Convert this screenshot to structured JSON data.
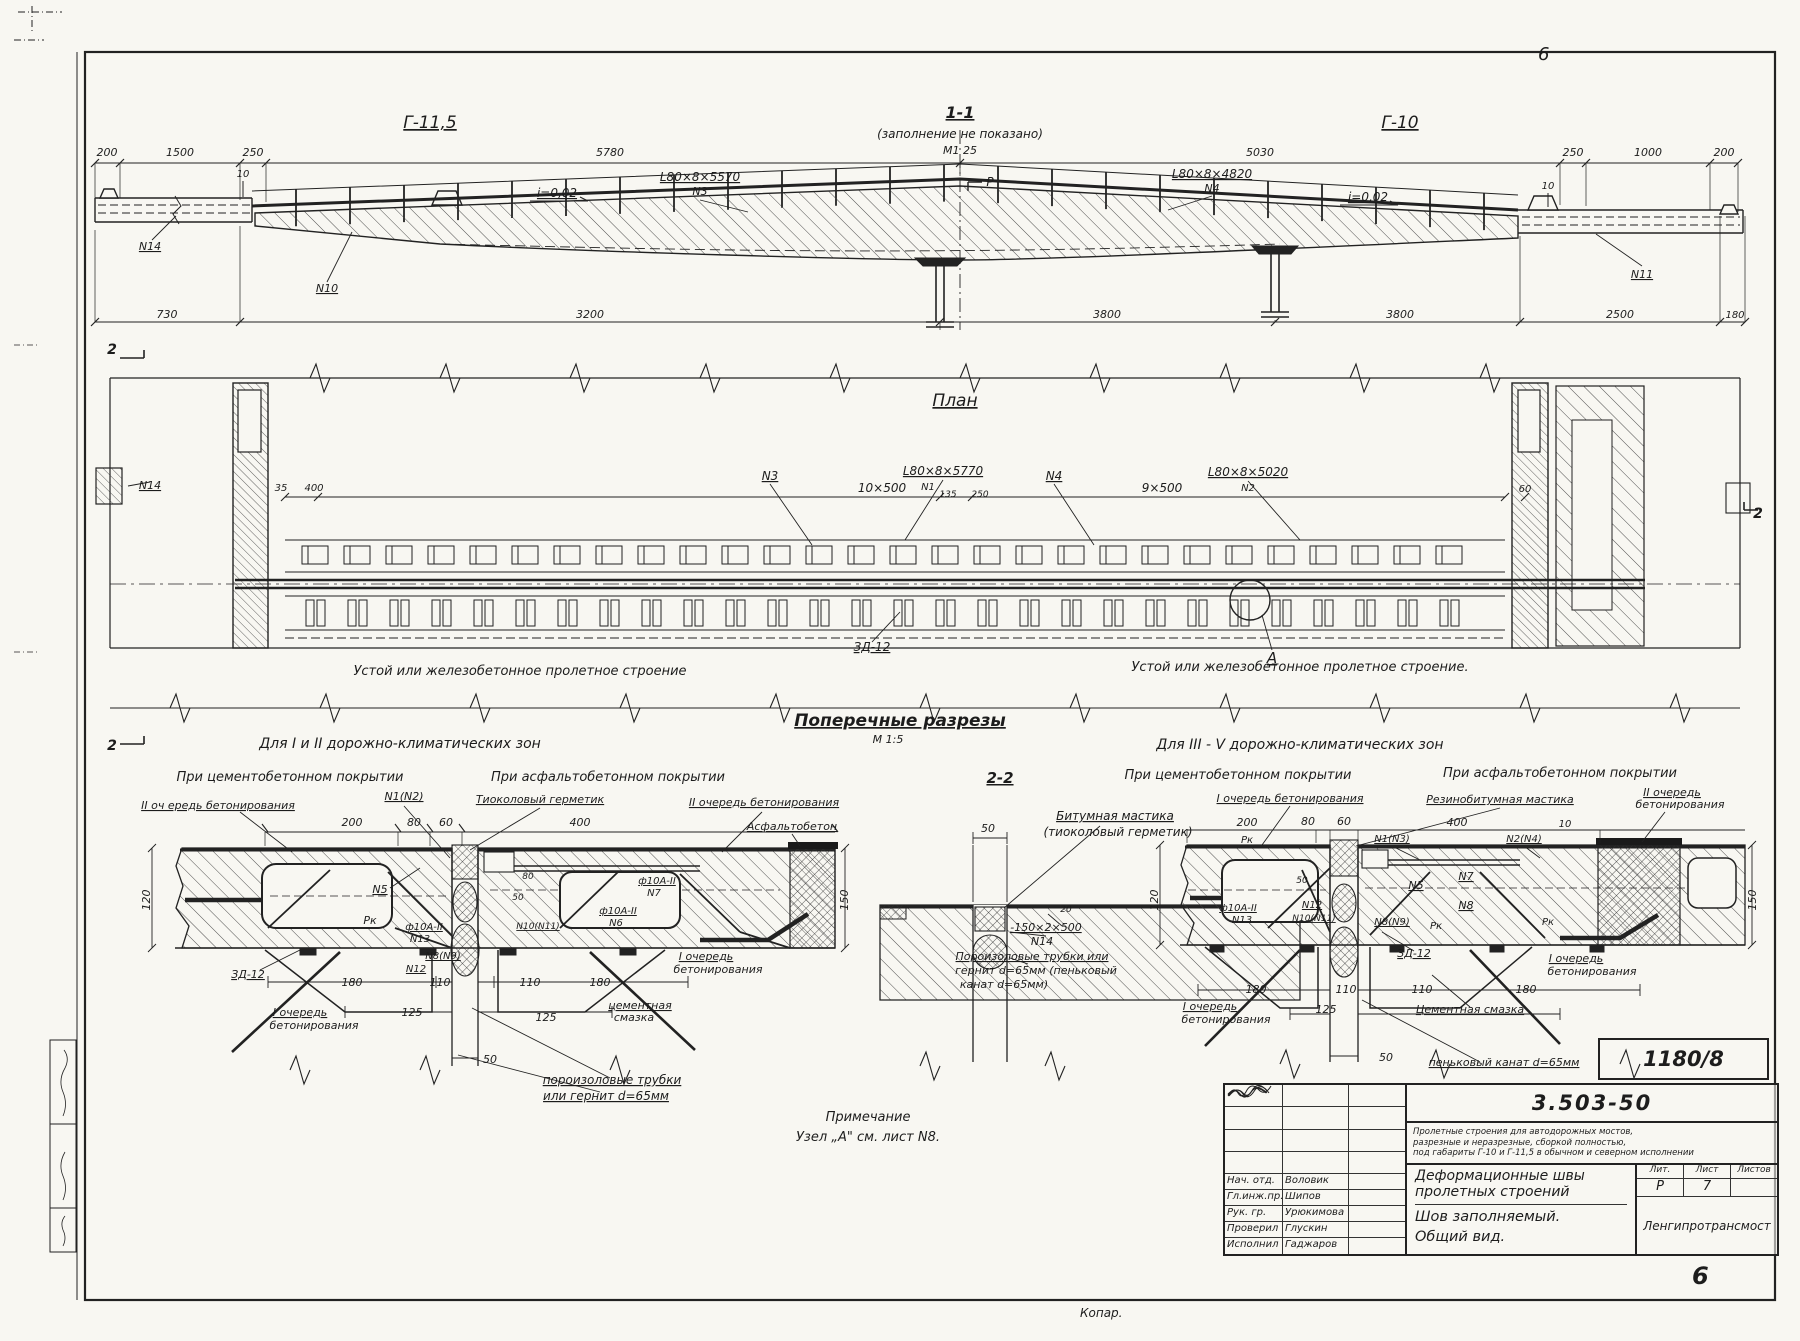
{
  "sheet": {
    "corner_mark": "6",
    "page_number": "6",
    "copier_note": "Копар.",
    "doc_stamp": "1180/8"
  },
  "title_block": {
    "series": "3.503-50",
    "desc_line1": "Пролетные строения для автодорожных мостов,",
    "desc_line2": "разрезные и неразрезные, сборкой полностью,",
    "desc_line3": "под габариты Г-10 и Г-11,5 в обычном и северном исполнении",
    "title_line1": "Деформационные швы",
    "title_line2": "пролетных строений",
    "sub_line1": "Шов заполняемый.",
    "sub_line2": "Общий вид.",
    "col_lit": "Лит.",
    "col_list": "Лист",
    "col_listov": "Листов",
    "val_lit": "Р",
    "val_list": "7",
    "val_listov": "",
    "org": "Ленгипротрансмост",
    "rows": [
      {
        "role": "Нач. отд.",
        "name": "Воловик"
      },
      {
        "role": "Гл.инж.пр.",
        "name": "Шипов"
      },
      {
        "role": "Рук. гр.",
        "name": "Урюкимова"
      },
      {
        "role": "Проверил",
        "name": "Глускин"
      },
      {
        "role": "Исполнил",
        "name": "Гаджаров"
      }
    ]
  },
  "drawing_labels": {
    "elevation": [
      {
        "t": "Г-11,5",
        "x": 430,
        "y": 128,
        "s": 17,
        "u": 1
      },
      {
        "t": "1-1",
        "x": 960,
        "y": 118,
        "s": 16,
        "u": 1,
        "w": 1
      },
      {
        "t": "(заполнение не показано)",
        "x": 960,
        "y": 138,
        "s": 12
      },
      {
        "t": "М1 25",
        "x": 960,
        "y": 154,
        "s": 11
      },
      {
        "t": "Г-10",
        "x": 1400,
        "y": 128,
        "s": 17,
        "u": 1
      },
      {
        "t": "200",
        "x": 107,
        "y": 156,
        "s": 11
      },
      {
        "t": "1500",
        "x": 180,
        "y": 156,
        "s": 11
      },
      {
        "t": "250",
        "x": 253,
        "y": 156,
        "s": 11
      },
      {
        "t": "5780",
        "x": 610,
        "y": 156,
        "s": 11
      },
      {
        "t": "5030",
        "x": 1260,
        "y": 156,
        "s": 11
      },
      {
        "t": "250",
        "x": 1573,
        "y": 156,
        "s": 11
      },
      {
        "t": "1000",
        "x": 1648,
        "y": 156,
        "s": 11
      },
      {
        "t": "200",
        "x": 1724,
        "y": 156,
        "s": 11
      },
      {
        "t": "i=0,02",
        "x": 557,
        "y": 197,
        "s": 12,
        "u": 1
      },
      {
        "t": "i=0,02",
        "x": 1368,
        "y": 201,
        "s": 12,
        "u": 1
      },
      {
        "t": "L80×8×5570",
        "x": 700,
        "y": 181,
        "s": 12,
        "u": 1
      },
      {
        "t": "N3",
        "x": 700,
        "y": 195,
        "s": 11
      },
      {
        "t": "L80×8×4820",
        "x": 1212,
        "y": 178,
        "s": 12,
        "u": 1
      },
      {
        "t": "N4",
        "x": 1212,
        "y": 192,
        "s": 11
      },
      {
        "t": "Р",
        "x": 990,
        "y": 186,
        "s": 12
      },
      {
        "t": "10",
        "x": 243,
        "y": 177,
        "s": 10
      },
      {
        "t": "10",
        "x": 1548,
        "y": 189,
        "s": 10
      },
      {
        "t": "N14",
        "x": 150,
        "y": 250,
        "s": 11,
        "u": 1
      },
      {
        "t": "N10",
        "x": 327,
        "y": 292,
        "s": 11,
        "u": 1
      },
      {
        "t": "N11",
        "x": 1642,
        "y": 278,
        "s": 11,
        "u": 1
      },
      {
        "t": "730",
        "x": 167,
        "y": 318,
        "s": 11
      },
      {
        "t": "3200",
        "x": 590,
        "y": 318,
        "s": 11
      },
      {
        "t": "3800",
        "x": 1107,
        "y": 318,
        "s": 11
      },
      {
        "t": "3800",
        "x": 1400,
        "y": 318,
        "s": 11
      },
      {
        "t": "2500",
        "x": 1620,
        "y": 318,
        "s": 11
      },
      {
        "t": "180",
        "x": 1735,
        "y": 318,
        "s": 10
      }
    ],
    "plan": [
      {
        "t": "План",
        "x": 955,
        "y": 406,
        "s": 17,
        "u": 1
      },
      {
        "t": "2",
        "x": 112,
        "y": 354,
        "s": 14,
        "w": 1
      },
      {
        "t": "2",
        "x": 112,
        "y": 750,
        "s": 14,
        "w": 1
      },
      {
        "t": "2",
        "x": 1758,
        "y": 518,
        "s": 14,
        "w": 1
      },
      {
        "t": "N14",
        "x": 150,
        "y": 489,
        "s": 11,
        "u": 1
      },
      {
        "t": "35",
        "x": 281,
        "y": 491,
        "s": 10
      },
      {
        "t": "400",
        "x": 314,
        "y": 491,
        "s": 10
      },
      {
        "t": "N3",
        "x": 770,
        "y": 480,
        "s": 12,
        "u": 1
      },
      {
        "t": "10×500",
        "x": 882,
        "y": 492,
        "s": 12
      },
      {
        "t": "L80×8×5770",
        "x": 943,
        "y": 475,
        "s": 12,
        "u": 1
      },
      {
        "t": "N1",
        "x": 928,
        "y": 490,
        "s": 10
      },
      {
        "t": "135",
        "x": 948,
        "y": 497,
        "s": 9
      },
      {
        "t": "250",
        "x": 980,
        "y": 497,
        "s": 9
      },
      {
        "t": "N4",
        "x": 1054,
        "y": 480,
        "s": 12,
        "u": 1
      },
      {
        "t": "9×500",
        "x": 1162,
        "y": 492,
        "s": 12
      },
      {
        "t": "L80×8×5020",
        "x": 1248,
        "y": 476,
        "s": 12,
        "u": 1
      },
      {
        "t": "N2",
        "x": 1248,
        "y": 491,
        "s": 10
      },
      {
        "t": "60",
        "x": 1525,
        "y": 492,
        "s": 10
      },
      {
        "t": "ЗД-12",
        "x": 872,
        "y": 651,
        "s": 12,
        "u": 1
      },
      {
        "t": "А",
        "x": 1272,
        "y": 663,
        "s": 15,
        "u": 1
      },
      {
        "t": "Устой  или  железобетонное  пролетное  строение",
        "x": 520,
        "y": 675,
        "s": 13
      },
      {
        "t": "Устой  или  железобетонное  пролетное  строение.",
        "x": 1300,
        "y": 671,
        "s": 13
      }
    ],
    "sections": [
      {
        "t": "Поперечные  разрезы",
        "x": 900,
        "y": 726,
        "s": 17,
        "u": 1,
        "w": 1
      },
      {
        "t": "М 1:5",
        "x": 888,
        "y": 743,
        "s": 11
      },
      {
        "t": "Для I и II дорожно-климатических  зон",
        "x": 400,
        "y": 748,
        "s": 14
      },
      {
        "t": "Для III - V дорожно-климатических  зон",
        "x": 1300,
        "y": 749,
        "s": 14
      },
      {
        "t": "При цементобетонном покрытии",
        "x": 290,
        "y": 781,
        "s": 13
      },
      {
        "t": "При асфальтобетонном покрытии",
        "x": 608,
        "y": 781,
        "s": 13
      },
      {
        "t": "2-2",
        "x": 1000,
        "y": 783,
        "s": 15,
        "u": 1,
        "w": 1
      },
      {
        "t": "При цементобетонном покрытии",
        "x": 1238,
        "y": 779,
        "s": 13
      },
      {
        "t": "При асфальтобетонном покрытии",
        "x": 1560,
        "y": 777,
        "s": 13
      },
      {
        "t": "II оч ередь бетонирования",
        "x": 218,
        "y": 809,
        "s": 11,
        "u": 1
      },
      {
        "t": "N1(N2)",
        "x": 404,
        "y": 800,
        "s": 11,
        "u": 1
      },
      {
        "t": "Тиоколовый герметик",
        "x": 540,
        "y": 803,
        "s": 11,
        "u": 1
      },
      {
        "t": "II очередь бетонирования",
        "x": 764,
        "y": 806,
        "s": 11,
        "u": 1
      },
      {
        "t": "Асфальтобетон",
        "x": 792,
        "y": 830,
        "s": 11,
        "u": 1
      },
      {
        "t": "200",
        "x": 352,
        "y": 826,
        "s": 11
      },
      {
        "t": "80",
        "x": 414,
        "y": 826,
        "s": 11
      },
      {
        "t": "60",
        "x": 446,
        "y": 826,
        "s": 11
      },
      {
        "t": "400",
        "x": 580,
        "y": 826,
        "s": 11
      },
      {
        "t": "120",
        "x": 150,
        "y": 900,
        "s": 11,
        "r": -90
      },
      {
        "t": "150",
        "x": 848,
        "y": 900,
        "s": 11,
        "r": -90
      },
      {
        "t": "N5",
        "x": 380,
        "y": 893,
        "s": 11,
        "u": 1
      },
      {
        "t": "Рк",
        "x": 370,
        "y": 924,
        "s": 11
      },
      {
        "t": "ф10А-II",
        "x": 424,
        "y": 930,
        "s": 10,
        "u": 1
      },
      {
        "t": "N13",
        "x": 420,
        "y": 942,
        "s": 10
      },
      {
        "t": "N8(N9)",
        "x": 443,
        "y": 959,
        "s": 10,
        "u": 1
      },
      {
        "t": "N12",
        "x": 416,
        "y": 972,
        "s": 10,
        "u": 1
      },
      {
        "t": "ЗД-12",
        "x": 248,
        "y": 978,
        "s": 11,
        "u": 1
      },
      {
        "t": "80",
        "x": 528,
        "y": 879,
        "s": 9
      },
      {
        "t": "50",
        "x": 518,
        "y": 900,
        "s": 9
      },
      {
        "t": "ф10А-II",
        "x": 657,
        "y": 884,
        "s": 10,
        "u": 1
      },
      {
        "t": "N7",
        "x": 654,
        "y": 896,
        "s": 10
      },
      {
        "t": "N10(N11)",
        "x": 538,
        "y": 929,
        "s": 9,
        "u": 1
      },
      {
        "t": "ф10А-II",
        "x": 618,
        "y": 914,
        "s": 10,
        "u": 1
      },
      {
        "t": "N6",
        "x": 616,
        "y": 926,
        "s": 10
      },
      {
        "t": "I очередь",
        "x": 706,
        "y": 960,
        "s": 11,
        "u": 1
      },
      {
        "t": "бетонирования",
        "x": 718,
        "y": 973,
        "s": 11
      },
      {
        "t": "180",
        "x": 352,
        "y": 986,
        "s": 11
      },
      {
        "t": "110",
        "x": 440,
        "y": 986,
        "s": 11
      },
      {
        "t": "110",
        "x": 530,
        "y": 986,
        "s": 11
      },
      {
        "t": "180",
        "x": 600,
        "y": 986,
        "s": 11
      },
      {
        "t": "125",
        "x": 412,
        "y": 1016,
        "s": 11
      },
      {
        "t": "125",
        "x": 546,
        "y": 1021,
        "s": 11
      },
      {
        "t": "I очередь",
        "x": 300,
        "y": 1016,
        "s": 11,
        "u": 1
      },
      {
        "t": "бетонирования",
        "x": 314,
        "y": 1029,
        "s": 11
      },
      {
        "t": "цементная",
        "x": 640,
        "y": 1009,
        "s": 11,
        "u": 1
      },
      {
        "t": "смазка",
        "x": 634,
        "y": 1021,
        "s": 11
      },
      {
        "t": "50",
        "x": 490,
        "y": 1063,
        "s": 11
      },
      {
        "t": "пороизоловые  трубки",
        "x": 612,
        "y": 1084,
        "s": 12,
        "u": 1
      },
      {
        "t": "или гернит  d=65мм",
        "x": 606,
        "y": 1100,
        "s": 12,
        "u": 1
      },
      {
        "t": "Битумная  мастика",
        "x": 1115,
        "y": 820,
        "s": 12,
        "u": 1
      },
      {
        "t": "(тиоколовый герметик)",
        "x": 1118,
        "y": 836,
        "s": 12
      },
      {
        "t": "50",
        "x": 988,
        "y": 832,
        "s": 11
      },
      {
        "t": "20",
        "x": 1066,
        "y": 912,
        "s": 9
      },
      {
        "t": "-150×2×500",
        "x": 1046,
        "y": 931,
        "s": 11,
        "u": 1
      },
      {
        "t": "N14",
        "x": 1042,
        "y": 945,
        "s": 11
      },
      {
        "t": "Пороизоловые трубки или",
        "x": 1032,
        "y": 960,
        "s": 11,
        "u": 1
      },
      {
        "t": "гернит d=65мм (пеньковый",
        "x": 1036,
        "y": 974,
        "s": 11
      },
      {
        "t": "канат d=65мм)",
        "x": 1004,
        "y": 988,
        "s": 11
      },
      {
        "t": "I очередь бетонирования",
        "x": 1290,
        "y": 802,
        "s": 11,
        "u": 1
      },
      {
        "t": "Резинобитумная мастика",
        "x": 1500,
        "y": 803,
        "s": 11,
        "u": 1
      },
      {
        "t": "II очередь",
        "x": 1672,
        "y": 796,
        "s": 11,
        "u": 1
      },
      {
        "t": "бетонирования",
        "x": 1680,
        "y": 808,
        "s": 11
      },
      {
        "t": "200",
        "x": 1247,
        "y": 826,
        "s": 11
      },
      {
        "t": "80",
        "x": 1308,
        "y": 825,
        "s": 11
      },
      {
        "t": "60",
        "x": 1344,
        "y": 825,
        "s": 11
      },
      {
        "t": "400",
        "x": 1457,
        "y": 826,
        "s": 11
      },
      {
        "t": "10",
        "x": 1565,
        "y": 827,
        "s": 10
      },
      {
        "t": "Рк",
        "x": 1247,
        "y": 843,
        "s": 10
      },
      {
        "t": "N1(N3)",
        "x": 1392,
        "y": 842,
        "s": 10,
        "u": 1
      },
      {
        "t": "N2(N4)",
        "x": 1524,
        "y": 842,
        "s": 10,
        "u": 1
      },
      {
        "t": "120",
        "x": 1158,
        "y": 900,
        "s": 11,
        "r": -90
      },
      {
        "t": "150",
        "x": 1756,
        "y": 900,
        "s": 11,
        "r": -90
      },
      {
        "t": "ф10А-II",
        "x": 1238,
        "y": 911,
        "s": 10,
        "u": 1
      },
      {
        "t": "N13",
        "x": 1242,
        "y": 923,
        "s": 10
      },
      {
        "t": "50",
        "x": 1302,
        "y": 883,
        "s": 9
      },
      {
        "t": "N12",
        "x": 1312,
        "y": 908,
        "s": 10,
        "u": 1
      },
      {
        "t": "N10(N11)",
        "x": 1314,
        "y": 921,
        "s": 9,
        "u": 1
      },
      {
        "t": "N5",
        "x": 1416,
        "y": 889,
        "s": 11,
        "u": 1
      },
      {
        "t": "N7",
        "x": 1466,
        "y": 880,
        "s": 11,
        "u": 1
      },
      {
        "t": "N8",
        "x": 1466,
        "y": 909,
        "s": 11,
        "u": 1
      },
      {
        "t": "N8(N9)",
        "x": 1392,
        "y": 925,
        "s": 10,
        "u": 1
      },
      {
        "t": "Рк",
        "x": 1436,
        "y": 929,
        "s": 10
      },
      {
        "t": "Рк",
        "x": 1548,
        "y": 925,
        "s": 10
      },
      {
        "t": "ЗД-12",
        "x": 1414,
        "y": 957,
        "s": 11,
        "u": 1
      },
      {
        "t": "I очередь",
        "x": 1576,
        "y": 962,
        "s": 11,
        "u": 1
      },
      {
        "t": "бетонирования",
        "x": 1592,
        "y": 975,
        "s": 11
      },
      {
        "t": "180",
        "x": 1256,
        "y": 993,
        "s": 11
      },
      {
        "t": "110",
        "x": 1346,
        "y": 993,
        "s": 11
      },
      {
        "t": "110",
        "x": 1422,
        "y": 993,
        "s": 11
      },
      {
        "t": "180",
        "x": 1526,
        "y": 993,
        "s": 11
      },
      {
        "t": "125",
        "x": 1326,
        "y": 1013,
        "s": 11
      },
      {
        "t": "I очередь",
        "x": 1210,
        "y": 1010,
        "s": 11,
        "u": 1
      },
      {
        "t": "бетонирования",
        "x": 1226,
        "y": 1023,
        "s": 11
      },
      {
        "t": "Цементная смазка",
        "x": 1470,
        "y": 1013,
        "s": 11,
        "u": 1
      },
      {
        "t": "50",
        "x": 1386,
        "y": 1061,
        "s": 11
      },
      {
        "t": "пеньковый  канат  d=65мм",
        "x": 1504,
        "y": 1066,
        "s": 11,
        "u": 1
      }
    ],
    "notes": [
      {
        "t": "Примечание",
        "x": 868,
        "y": 1121,
        "s": 13
      },
      {
        "t": "Узел „А\"  см.  лист  N8.",
        "x": 868,
        "y": 1141,
        "s": 13
      }
    ]
  }
}
